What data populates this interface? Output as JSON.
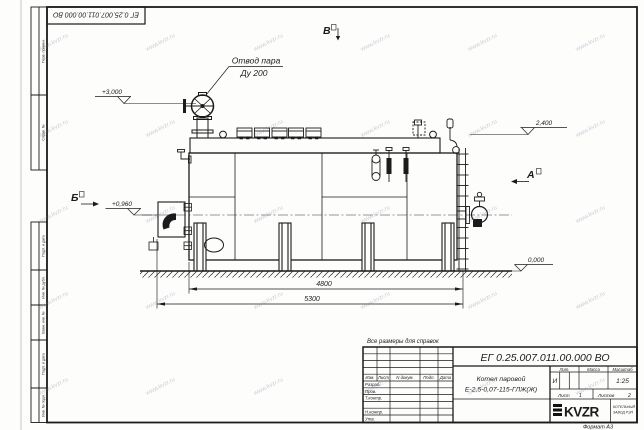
{
  "frame": {
    "top_left_designation": "ЕГ 0.25.007.011.00.000  ВО",
    "margin_columns": [
      "Перв. примен.",
      "Справ. №",
      "Подп. и дата",
      "Инв. № дубл.",
      "Взам. инв. №",
      "Подп. и дата",
      "Инв. № подл."
    ],
    "format_note": "Формат А3"
  },
  "drawing": {
    "note": "Все размеры для справок",
    "labels": {
      "steam_outlet_line1": "Отвод пара",
      "steam_outlet_line2": "Ду 200"
    },
    "dimensions": {
      "supports_span": "4800",
      "overall_length": "5300"
    },
    "elevations": {
      "valve_top": "+3,000",
      "drum_top": "2,400",
      "burner_axis": "+0,960",
      "ground": "0,000"
    },
    "views": {
      "left": "Б",
      "right": "А",
      "top": "В"
    }
  },
  "title_block": {
    "designation": "ЕГ 0.25.007.011.00.000  ВО",
    "product_name_line1": "Котел паровой",
    "product_name_line2": "Е-2,5-0,07-115-ГЛЖ(Ж)",
    "header_columns": [
      "Изм.",
      "Лист",
      "N докум.",
      "Подп.",
      "Дата"
    ],
    "row_labels": [
      "Разраб.",
      "Пров.",
      "Т.контр.",
      "Н.контр.",
      "Утв."
    ],
    "litera_label": "Лит.",
    "litera_value": "И",
    "mass_label": "Масса",
    "scale_label": "Масштаб",
    "scale_value": "1:25",
    "sheet_label": "Лист",
    "sheet_value": "1",
    "sheets_label": "Листов",
    "sheets_value": "2",
    "logo_text": "KVZR",
    "logo_caption_line1": "КОТЕЛЬНЫЙ",
    "logo_caption_line2": "ЗАВОД РЭП"
  },
  "watermark": {
    "text": "www.kvzr.ru"
  }
}
